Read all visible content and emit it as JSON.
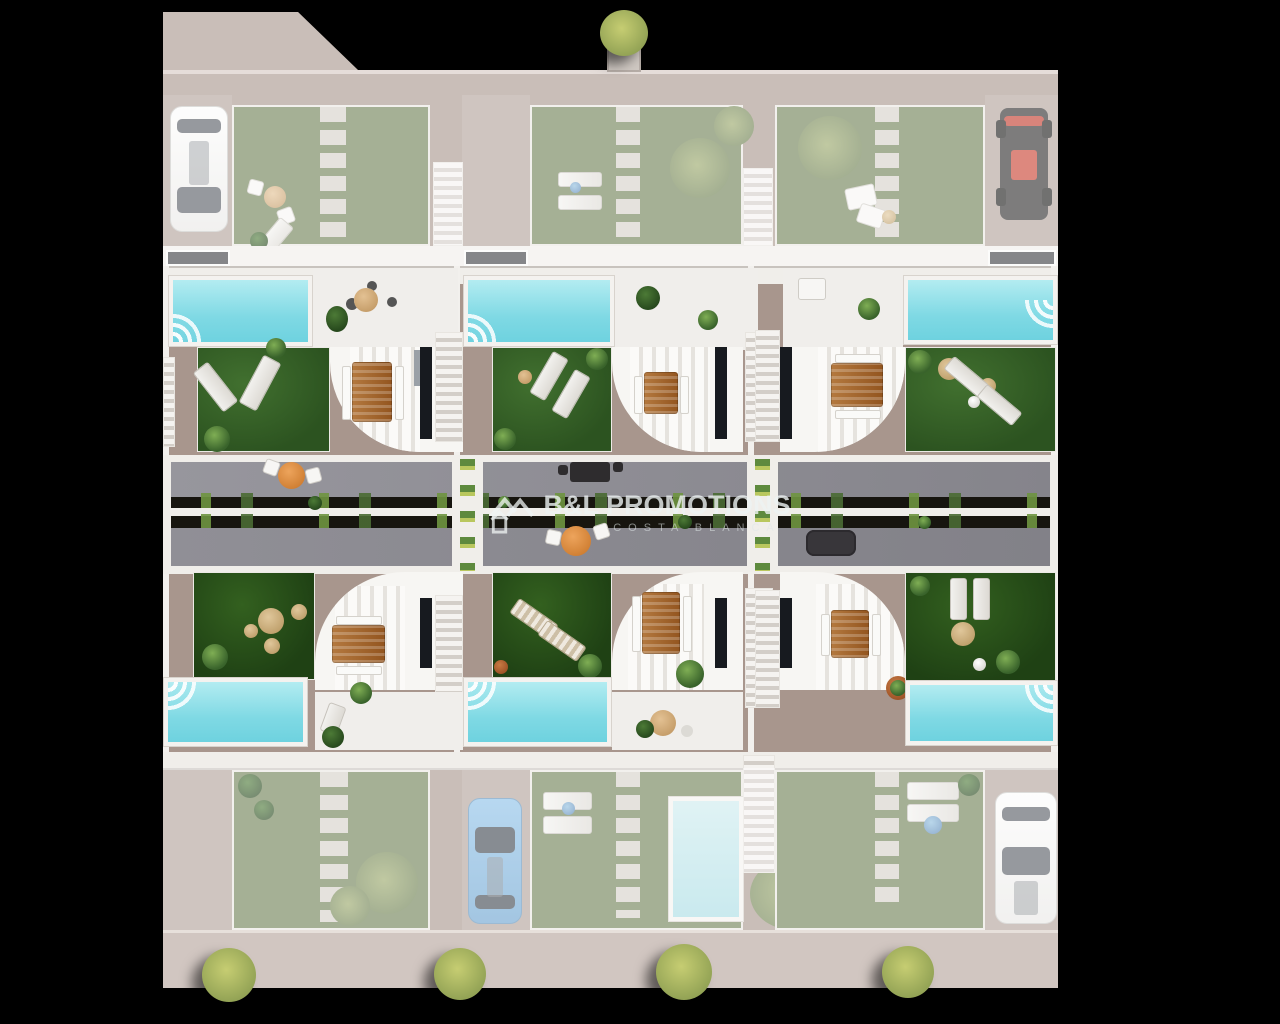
{
  "watermark": {
    "brand": "B&L PROMOTIONS",
    "subtitle": "COSTA BLANCA",
    "logo_icon": "twin-gable-house-logo"
  },
  "palette": {
    "background": "#000000",
    "pavement": "#a8968d",
    "faded_garden_green": "#6f8054",
    "vivid_lawn_green": "#2c5320",
    "deep_lawn_green": "#1f4114",
    "pool_water": "#7fd9e4",
    "street_deck_gray": "#8f8e94",
    "planting_strip_dark": "#17150f",
    "structure_white": "#f3f1ee",
    "wood_brown": "#a96a33",
    "accent_orange": "#d07f33",
    "car_blue": "#6ba3d0",
    "car_white": "#f8f8f7",
    "buggy_red": "#c8402f"
  }
}
